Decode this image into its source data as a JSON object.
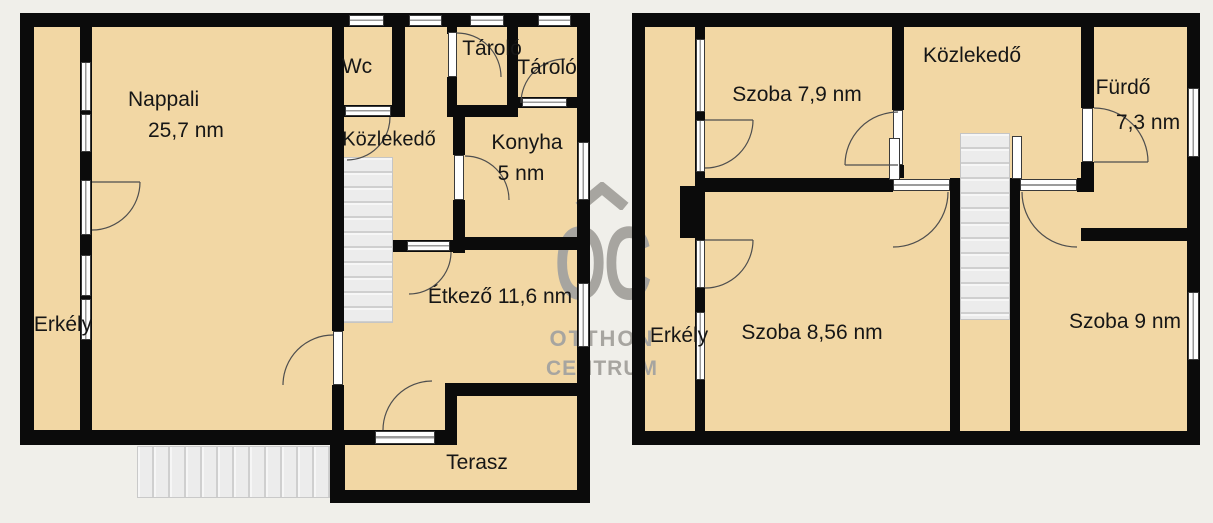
{
  "document_type": "floorplan",
  "unit_suffix": "nm",
  "colors": {
    "background": "#f0efea",
    "room_fill": "#f2d7a4",
    "wall": "#0b0b0b",
    "stairs": "#ececec",
    "watermark_gray": "#a7a5a0"
  },
  "watermark": {
    "logo": "OC",
    "brand_line1": "OTTHON",
    "brand_line2": "CENTRUM"
  },
  "left_plan": {
    "rooms": {
      "nappali": {
        "name": "Nappali",
        "area": "25,7 nm"
      },
      "wc": {
        "name": "Wc"
      },
      "tarolo_1": {
        "name": "Tároló"
      },
      "tarolo_2": {
        "name": "Tároló"
      },
      "kozlekedo": {
        "name": "Közlekedő"
      },
      "konyha": {
        "name": "Konyha",
        "area": "5 nm"
      },
      "etkezo": {
        "name": "Étkező 11,6 nm"
      },
      "erkely": {
        "name": "Erkély"
      },
      "terasz": {
        "name": "Terasz"
      }
    }
  },
  "right_plan": {
    "rooms": {
      "szoba_79": {
        "name": "Szoba 7,9 nm"
      },
      "kozlekedo": {
        "name": "Közlekedő"
      },
      "furdo": {
        "name": "Fürdő",
        "area": "7,3 nm"
      },
      "erkely": {
        "name": "Erkély"
      },
      "szoba_856": {
        "name": "Szoba 8,56 nm"
      },
      "szoba_9": {
        "name": "Szoba 9 nm"
      }
    }
  }
}
